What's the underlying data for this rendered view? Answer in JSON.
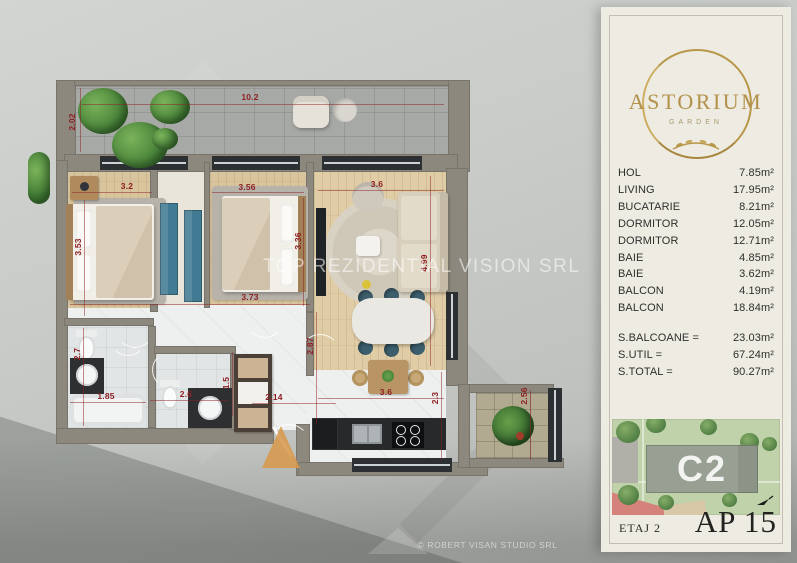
{
  "colors": {
    "accent_gold": "#b3914a",
    "dimension_red": "#8e2023",
    "wall_taupe": "#8d887d",
    "panel_cream": "#edebe2"
  },
  "plan": {
    "watermark": "TOP REZIDENTIAL VISION SRL",
    "copyright": "© ROBERT VISAN STUDIO SRL",
    "dimensions": [
      {
        "text": "10.2",
        "x": 250,
        "y": 97,
        "v": false,
        "line": {
          "x": 82,
          "y": 104,
          "len": 362
        }
      },
      {
        "text": "2.02",
        "x": 72,
        "y": 122,
        "v": true,
        "line": {
          "x": 80,
          "y": 88,
          "len": 64
        }
      },
      {
        "text": "3.2",
        "x": 127,
        "y": 186,
        "v": false,
        "line": {
          "x": 72,
          "y": 192,
          "len": 80
        }
      },
      {
        "text": "3.53",
        "x": 78,
        "y": 247,
        "v": true,
        "line": {
          "x": 84,
          "y": 200,
          "len": 116
        }
      },
      {
        "text": "3.56",
        "x": 247,
        "y": 187,
        "v": false,
        "line": {
          "x": 212,
          "y": 192,
          "len": 92
        }
      },
      {
        "text": "3.36",
        "x": 298,
        "y": 241,
        "v": true,
        "line": {
          "x": 303,
          "y": 198,
          "len": 108
        }
      },
      {
        "text": "3.6",
        "x": 377,
        "y": 184,
        "v": false,
        "line": {
          "x": 318,
          "y": 190,
          "len": 126
        }
      },
      {
        "text": "4.99",
        "x": 424,
        "y": 263,
        "v": true,
        "line": {
          "x": 430,
          "y": 176,
          "len": 190
        }
      },
      {
        "text": "3.73",
        "x": 250,
        "y": 297,
        "v": false,
        "line": {
          "x": 70,
          "y": 304,
          "len": 240
        }
      },
      {
        "text": "2.87",
        "x": 310,
        "y": 346,
        "v": true,
        "line": {
          "x": 316,
          "y": 312,
          "len": 112
        }
      },
      {
        "text": "2.7",
        "x": 77,
        "y": 354,
        "v": true,
        "line": {
          "x": 83,
          "y": 328,
          "len": 98
        }
      },
      {
        "text": "1.85",
        "x": 106,
        "y": 396,
        "v": false,
        "line": {
          "x": 70,
          "y": 402,
          "len": 76
        }
      },
      {
        "text": "2.6",
        "x": 186,
        "y": 394,
        "v": false,
        "line": {
          "x": 150,
          "y": 400,
          "len": 78
        }
      },
      {
        "text": "1.5",
        "x": 226,
        "y": 383,
        "v": true,
        "line": {
          "x": 232,
          "y": 352,
          "len": 64
        }
      },
      {
        "text": "2.14",
        "x": 274,
        "y": 397,
        "v": false,
        "line": {
          "x": 252,
          "y": 403,
          "len": 84
        }
      },
      {
        "text": "3.6",
        "x": 386,
        "y": 392,
        "v": false,
        "line": {
          "x": 318,
          "y": 398,
          "len": 126
        }
      },
      {
        "text": "2.3",
        "x": 435,
        "y": 398,
        "v": true,
        "line": {
          "x": 441,
          "y": 372,
          "len": 88
        }
      },
      {
        "text": "2.56",
        "x": 524,
        "y": 396,
        "v": true,
        "line": {
          "x": 530,
          "y": 390,
          "len": 70
        }
      }
    ]
  },
  "panel": {
    "logo": {
      "name": "ASTORIUM",
      "subtitle": "GARDEN"
    },
    "rooms": [
      {
        "label": "HOL",
        "area": "7.85m²"
      },
      {
        "label": "LIVING",
        "area": "17.95m²"
      },
      {
        "label": "BUCATARIE",
        "area": "8.21m²"
      },
      {
        "label": "DORMITOR",
        "area": "12.05m²"
      },
      {
        "label": "DORMITOR",
        "area": "12.71m²"
      },
      {
        "label": "BAIE",
        "area": "4.85m²"
      },
      {
        "label": "BAIE",
        "area": "3.62m²"
      },
      {
        "label": "BALCON",
        "area": "4.19m²"
      },
      {
        "label": "BALCON",
        "area": "18.84m²"
      }
    ],
    "totals": [
      {
        "label": "S.BALCOANE =",
        "area": "23.03m²"
      },
      {
        "label": "S.UTIL =",
        "area": "67.24m²"
      },
      {
        "label": "S.TOTAL =",
        "area": "90.27m²"
      }
    ],
    "siteplan": {
      "building": "C2"
    },
    "floor": "ETAJ 2",
    "apartment": "AP 15"
  }
}
